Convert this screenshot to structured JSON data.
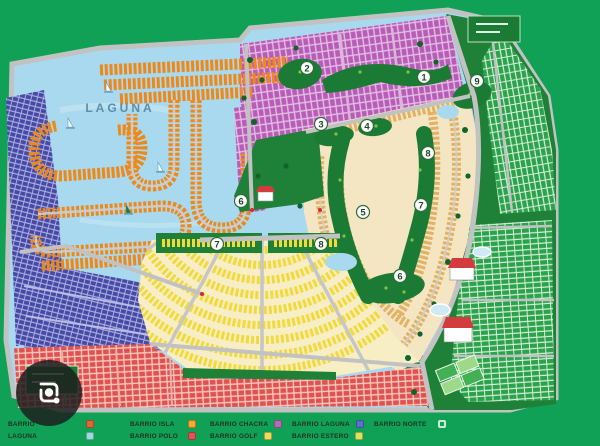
{
  "map": {
    "laguna_label": "LAGUNA",
    "markers": [
      {
        "n": "2"
      },
      {
        "n": "1"
      },
      {
        "n": "9"
      },
      {
        "n": "3"
      },
      {
        "n": "4"
      },
      {
        "n": "8"
      },
      {
        "n": "5"
      },
      {
        "n": "7"
      },
      {
        "n": "6"
      },
      {
        "n": "6"
      },
      {
        "n": "7"
      },
      {
        "n": "8"
      }
    ],
    "colors": {
      "background_green": "#10a156",
      "water": "#a9d9ee",
      "lot_orange": "#ee8818",
      "lot_indigo": "#474aa5",
      "lot_magenta": "#b85cb8",
      "lot_yellow": "#f0da3e",
      "lot_red": "#e25050",
      "lot_green": "#2aa34c",
      "lot_tan": "#e2b264",
      "fairway_green": "#1b7a33",
      "road_gray": "#c2c2c2"
    }
  },
  "legend": {
    "items": [
      {
        "label": "BARRIO",
        "color": "#e0663a"
      },
      {
        "label": "LAGUNA",
        "color": "#9adcdc"
      },
      {
        "label": "BARRIO ISLA",
        "color": "#f5a832"
      },
      {
        "label": "BARRIO POLO",
        "color": "#e05454"
      },
      {
        "label": "BARRIO CHACRA",
        "color": "#b56ab5"
      },
      {
        "label": "BARRIO GOLF",
        "color": "#ecde5a"
      },
      {
        "label": "BARRIO LAGUNA",
        "color": "#5b6fd0"
      },
      {
        "label": "BARRIO ESTERO",
        "color": "#dce45e"
      },
      {
        "label": "BARRIO NORTE",
        "color": "#ffffff"
      }
    ]
  },
  "icons": {
    "camera": "lens-camera-icon"
  }
}
